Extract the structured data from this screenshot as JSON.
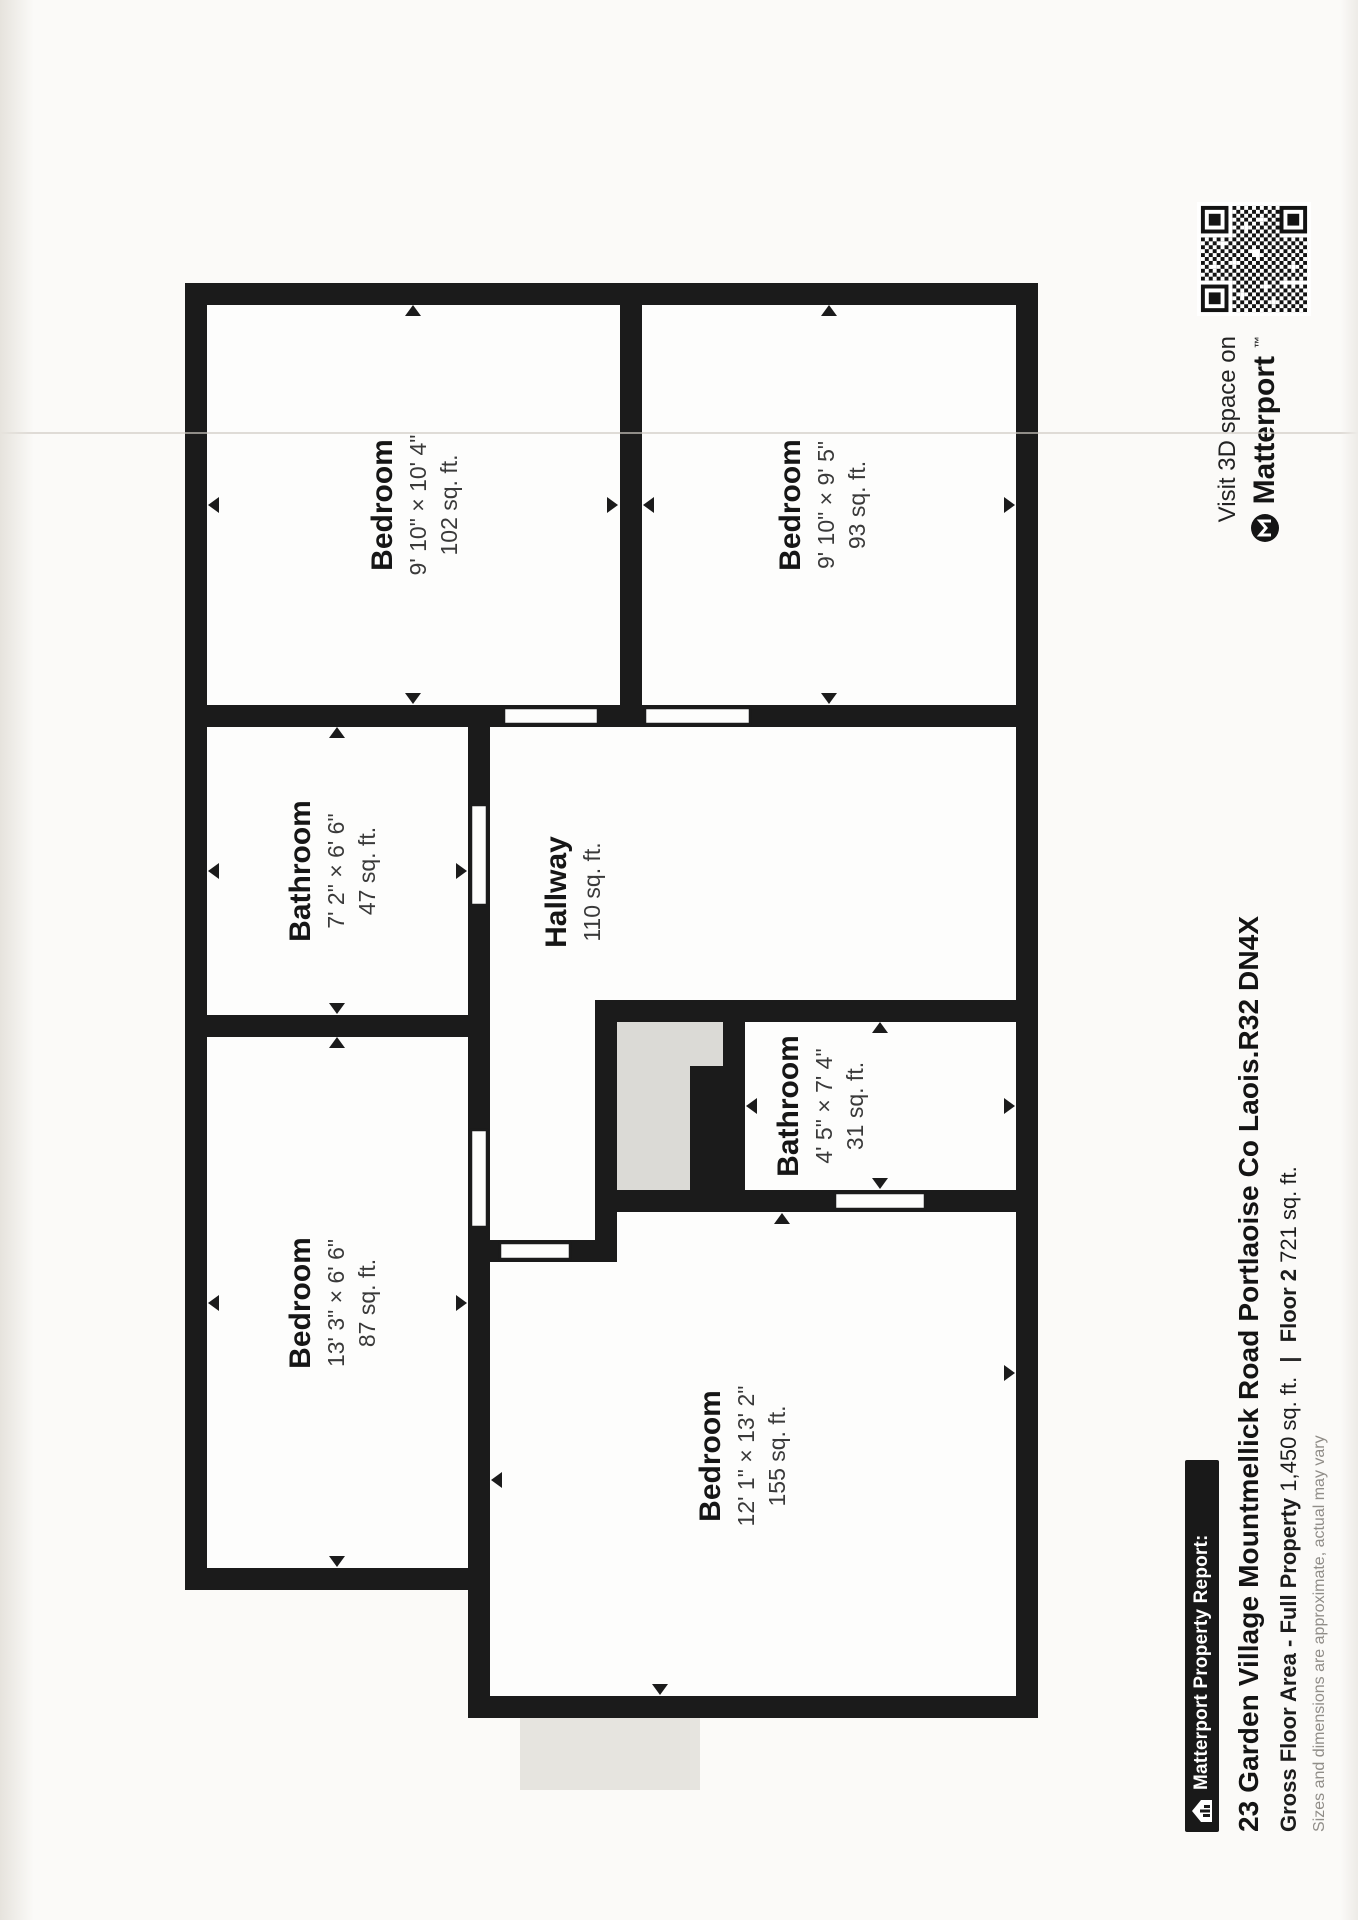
{
  "report": {
    "brand_label": "Matterport Property Report:",
    "address": "23 Garden Village Mountmellick Road Portlaoise Co Laois.R32 DN4X",
    "gross_area_label": "Gross Floor Area - Full Property",
    "gross_area_value": "1,450 sq. ft.",
    "separator": "|",
    "floor_label": "Floor 2",
    "floor_value": "721 sq. ft.",
    "disclaimer": "Sizes and dimensions are approximate, actual may vary"
  },
  "qr_panel": {
    "line1": "Visit 3D space on",
    "brand": "Matterport",
    "trademark": "™"
  },
  "floor_plan": {
    "rooms": [
      {
        "id": "bedroom-1",
        "name": "Bedroom",
        "dims": "9' 10\" × 10' 4\"",
        "area": "102 sq. ft."
      },
      {
        "id": "bedroom-2",
        "name": "Bedroom",
        "dims": "9' 10\" × 9' 5\"",
        "area": "93 sq. ft."
      },
      {
        "id": "bathroom-1",
        "name": "Bathroom",
        "dims": "7' 2\" × 6' 6\"",
        "area": "47 sq. ft."
      },
      {
        "id": "hallway",
        "name": "Hallway",
        "dims": "",
        "area": "110 sq. ft."
      },
      {
        "id": "bedroom-3",
        "name": "Bedroom",
        "dims": "13' 3\" × 6' 6\"",
        "area": "87 sq. ft."
      },
      {
        "id": "bathroom-2",
        "name": "Bathroom",
        "dims": "4' 5\" × 7' 4\"",
        "area": "31 sq. ft."
      },
      {
        "id": "bedroom-4",
        "name": "Bedroom",
        "dims": "12' 1\" × 13' 2\"",
        "area": "155 sq. ft."
      }
    ]
  },
  "colors": {
    "wall": "#1b1b1b",
    "void_fill": "#dbdad6",
    "paper": "#fbfaf8"
  }
}
